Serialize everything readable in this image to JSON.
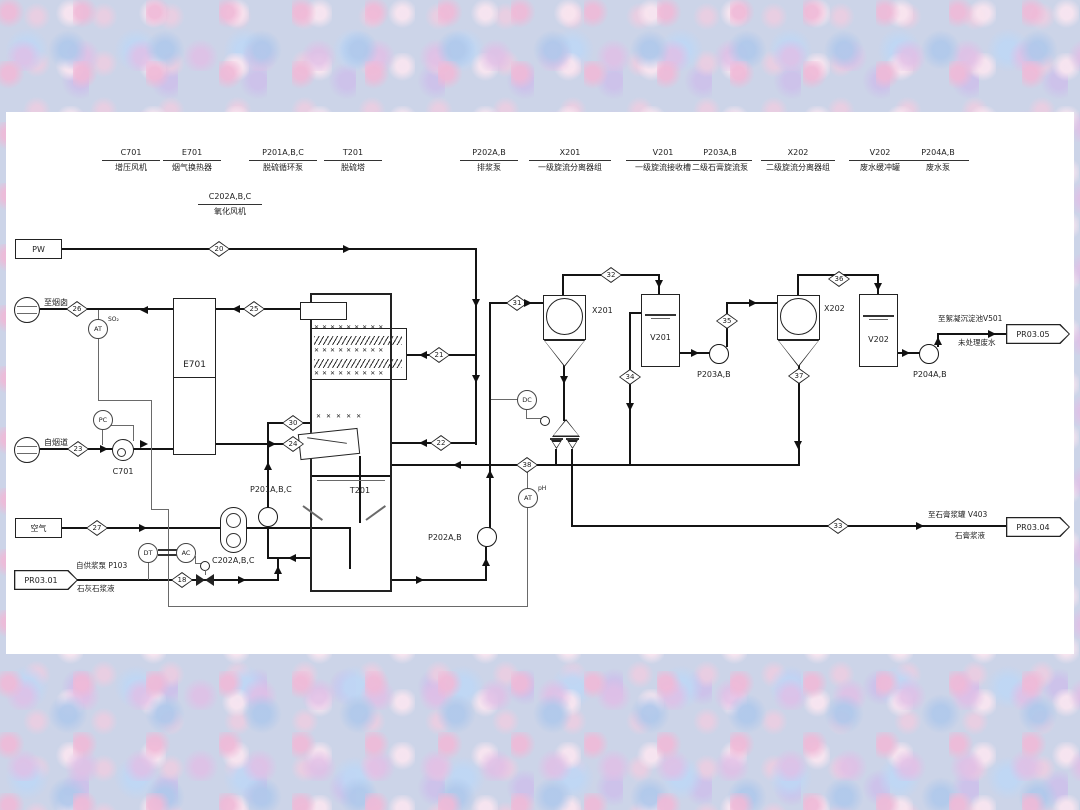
{
  "equipment_index": [
    {
      "tag": "C701",
      "desc": "增压风机"
    },
    {
      "tag": "E701",
      "desc": "烟气换热器"
    },
    {
      "tag": "P201A,B,C",
      "desc": "脱硫循环泵"
    },
    {
      "tag": "T201",
      "desc": "脱硫塔"
    },
    {
      "tag": "C202A,B,C",
      "desc": "氧化风机"
    },
    {
      "tag": "P202A,B",
      "desc": "排浆泵"
    },
    {
      "tag": "X201",
      "desc": "一级旋流分离器组"
    },
    {
      "tag": "V201",
      "desc": "一级旋流接收槽"
    },
    {
      "tag": "P203A,B",
      "desc": "二级石膏旋流泵"
    },
    {
      "tag": "X202",
      "desc": "二级旋流分离器组"
    },
    {
      "tag": "V202",
      "desc": "废水缓冲罐"
    },
    {
      "tag": "P204A,B",
      "desc": "废水泵"
    }
  ],
  "streams": {
    "s18": "18",
    "s20": "20",
    "s21": "21",
    "s22": "22",
    "s23": "23",
    "s24": "24",
    "s25": "25",
    "s26": "26",
    "s27": "27",
    "s30": "30",
    "s31": "31",
    "s32": "32",
    "s33": "33",
    "s34": "34",
    "s35": "35",
    "s36": "36",
    "s37": "37",
    "s38": "38"
  },
  "sources": {
    "pw": "PW",
    "air": "空气",
    "to_stack": "至烟囱",
    "from_flue": "自烟道",
    "pr0301": {
      "id": "PR03.01",
      "line1": "自供浆泵 P103",
      "line2": "石灰石浆液"
    },
    "pr0304": {
      "id": "PR03.04",
      "line1": "至石膏浆罐 V403",
      "line2": "石膏浆液"
    },
    "pr0305": {
      "id": "PR03.05",
      "line1": "至絮凝沉淀池V501",
      "line2": "未处理废水"
    }
  },
  "equipment_labels": {
    "e701": "E701",
    "c701": "C701",
    "p201": "P201A,B,C",
    "t201": "T201",
    "c202": "C202A,B,C",
    "p202": "P202A,B",
    "x201": "X201",
    "v201": "V201",
    "p203": "P203A,B",
    "x202": "X202",
    "v202": "V202",
    "p204": "P204A,B"
  },
  "instruments": {
    "at_so2": "AT",
    "at_so2_sup": "SO₂",
    "pc": "PC",
    "dt": "DT",
    "ac": "AC",
    "dc": "DC",
    "at_ph": "AT",
    "at_ph_sup": "pH"
  },
  "colors": {
    "line": "#141414",
    "sheet": "#ffffff"
  }
}
